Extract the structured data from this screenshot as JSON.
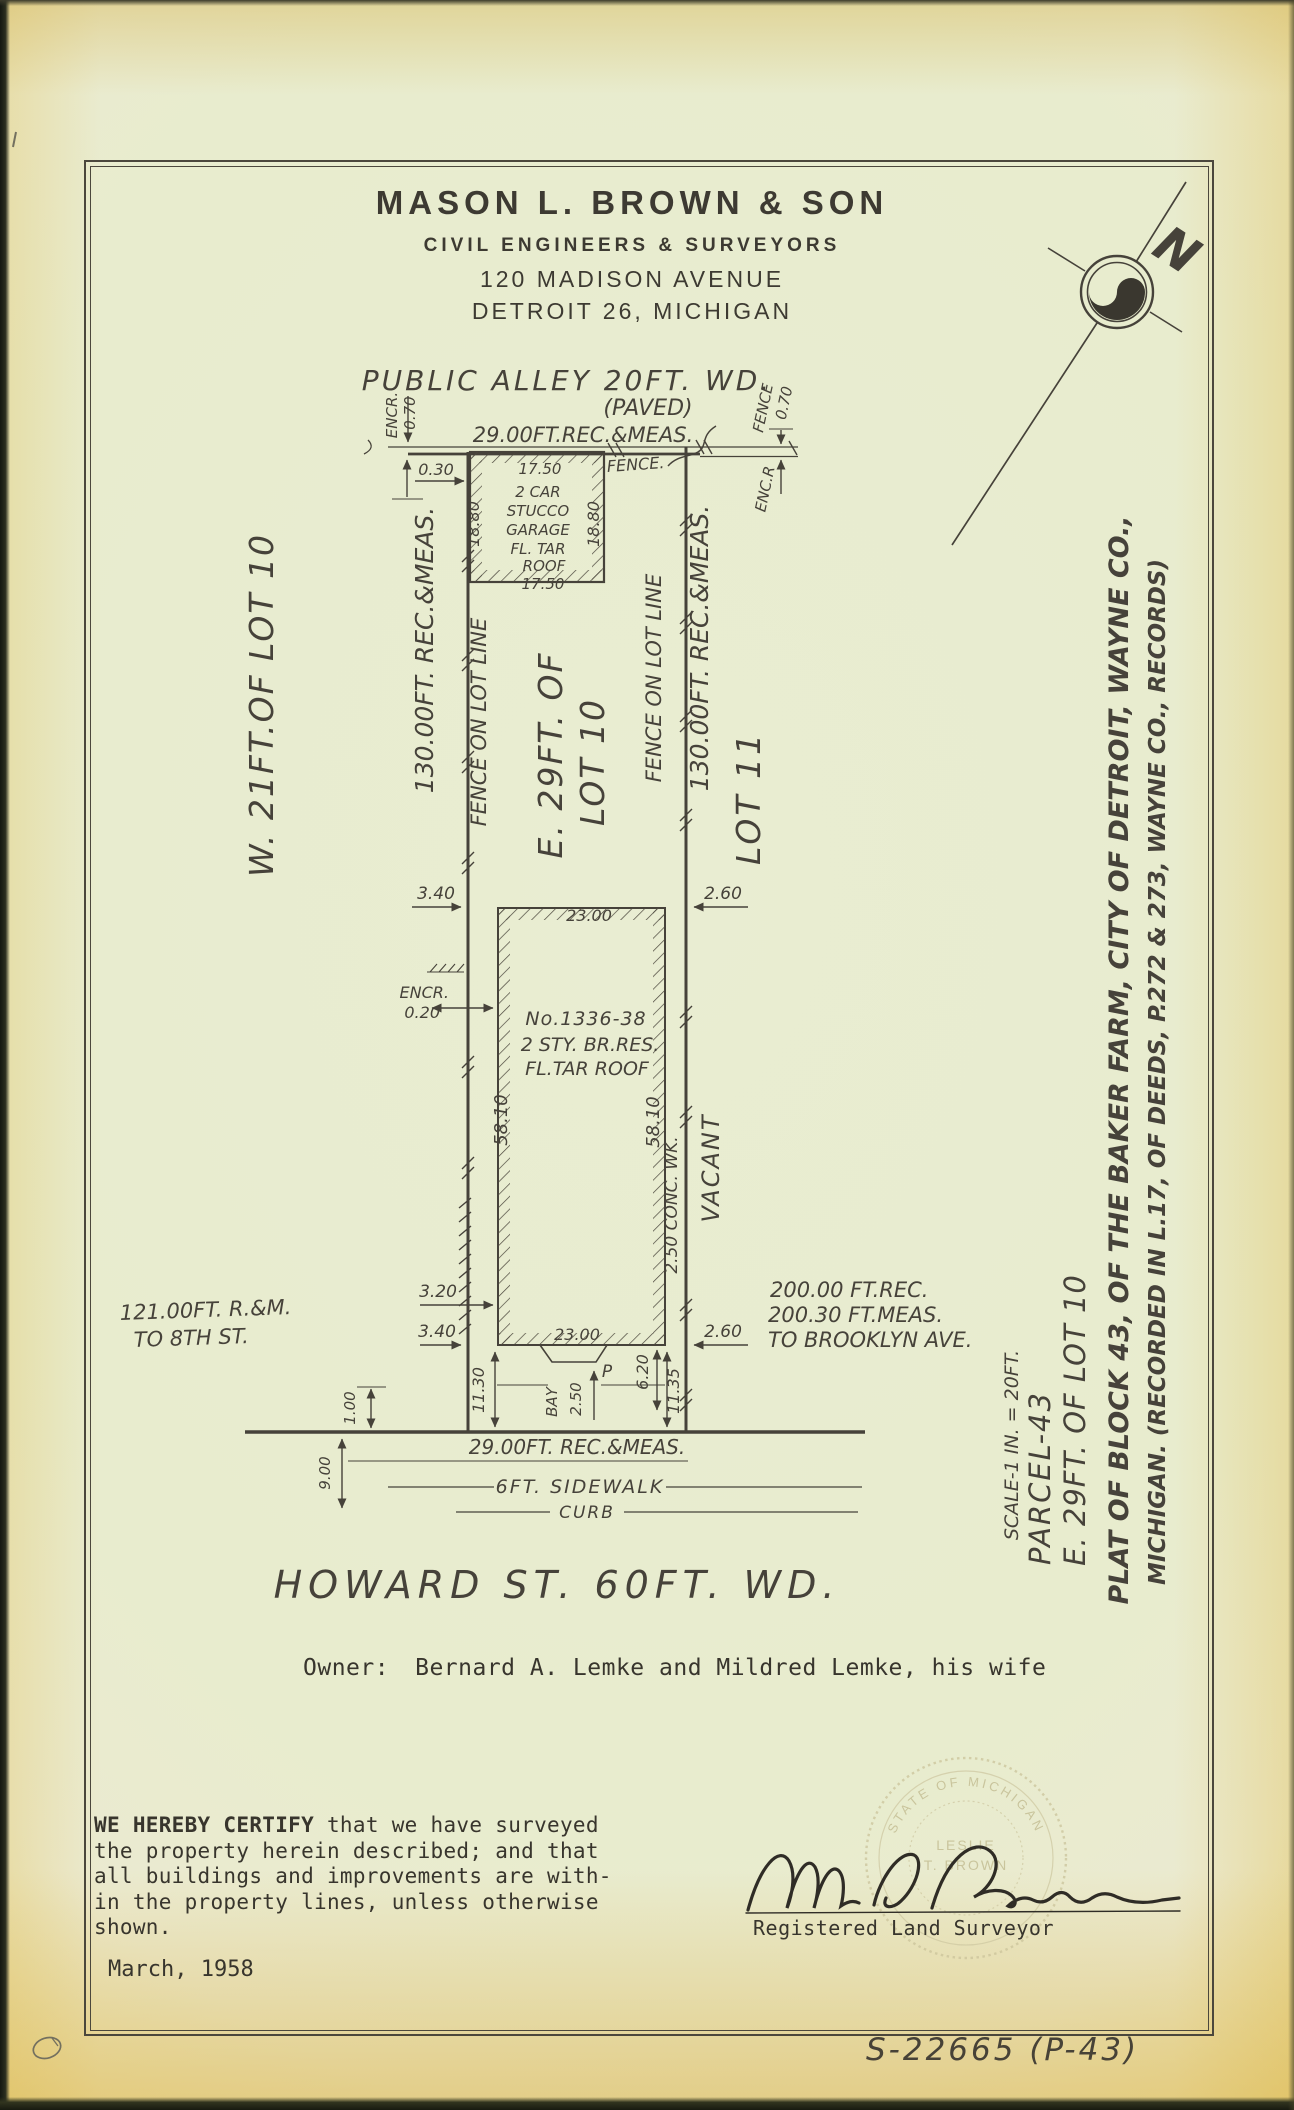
{
  "letterhead": {
    "company": "MASON L. BROWN & SON",
    "subtitle": "CIVIL ENGINEERS & SURVEYORS",
    "address": "120 MADISON AVENUE",
    "city": "DETROIT 26, MICHIGAN"
  },
  "compass": {
    "north": "N"
  },
  "plat": {
    "alley": {
      "title": "PUBLIC ALLEY 20FT. WD.",
      "paved": "(PAVED)",
      "rear_dim": "29.00FT.REC.&MEAS.",
      "fence_label": "FENCE.",
      "encr_label": "ENCR.",
      "encr_value": "0.70",
      "garage_offset": "0.30",
      "fence_ne": "FENCE",
      "fence_ne_value": "0.70",
      "encr_ne": "ENC.R"
    },
    "garage": {
      "label_lines": [
        "2 CAR",
        "STUCCO",
        "GARAGE",
        "FL. TAR",
        "ROOF"
      ],
      "width_top": "17.50",
      "width_bottom": "17.50",
      "depth_left": "18.80",
      "depth_right": "18.80"
    },
    "west_parcel_label": "W. 21FT.OF LOT 10",
    "west_depth": "130.00FT. REC.&MEAS.",
    "west_fence": "FENCE ON LOT LINE",
    "parcel_line1": "E. 29FT. OF",
    "parcel_line2": "LOT 10",
    "east_fence": "FENCE ON LOT LINE",
    "east_depth": "130.00FT. REC.&MEAS.",
    "lot11": "LOT 11",
    "house": {
      "number": "No.1336-38",
      "desc": "2 STY. BR.RES.",
      "roof": "FL.TAR ROOF",
      "width_top": "23.00",
      "width_bottom": "23.00",
      "depth_left": "58.10",
      "depth_right": "58.10"
    },
    "dims": {
      "nw": "3.40",
      "ne": "2.60",
      "encr_label": "ENCR.",
      "encr_value": "0.20",
      "sw_upper": "3.20",
      "sw_lower": "3.40",
      "se": "2.60",
      "south_left": "11.30",
      "south_right": "11.35",
      "porch_depth": "6.20",
      "bay_label": "BAY",
      "bay_width": "2.50",
      "porch_label": "P",
      "conc_walk": "2.50 CONC. WK.",
      "vacant": "VACANT",
      "front_offset": "1.00",
      "parkway": "9.00"
    },
    "front": {
      "dim": "29.00FT. REC.&MEAS.",
      "sidewalk": "6FT. SIDEWALK",
      "curb": "CURB",
      "street": "HOWARD ST. 60FT. WD."
    },
    "ref_west": [
      "121.00FT. R.&M.",
      "TO 8TH ST."
    ],
    "ref_east": [
      "200.00 FT.REC.",
      "200.30 FT.MEAS.",
      "TO BROOKLYN AVE."
    ],
    "title_block": {
      "scale": "SCALE-1 IN. = 20FT.",
      "parcel": "PARCEL-43",
      "description": "E. 29FT. OF LOT 10",
      "plat_line1": "PLAT OF BLOCK 43, OF THE BAKER FARM, CITY OF DETROIT, WAYNE CO.,",
      "plat_line2": "MICHIGAN. (RECORDED IN L.17, OF DEEDS, P.272 & 273, WAYNE CO., RECORDS)"
    }
  },
  "owner": {
    "label": "Owner:",
    "name": "Bernard A. Lemke and Mildred Lemke, his wife"
  },
  "certification": {
    "emphasis": "WE HEREBY CERTIFY",
    "line1_rest": " that we have surveyed",
    "lines": [
      "the property herein described; and that",
      "all buildings and improvements are with-",
      "in the property lines, unless otherwise",
      "shown."
    ],
    "date": "March, 1958",
    "signer_title": "Registered Land Surveyor"
  },
  "seal": {
    "arc_top": "STATE OF MICHIGAN",
    "name_line1": "LESLIE",
    "name_line2": "T. BROWN"
  },
  "footer": {
    "document_id": "S-22665 (P-43)"
  }
}
